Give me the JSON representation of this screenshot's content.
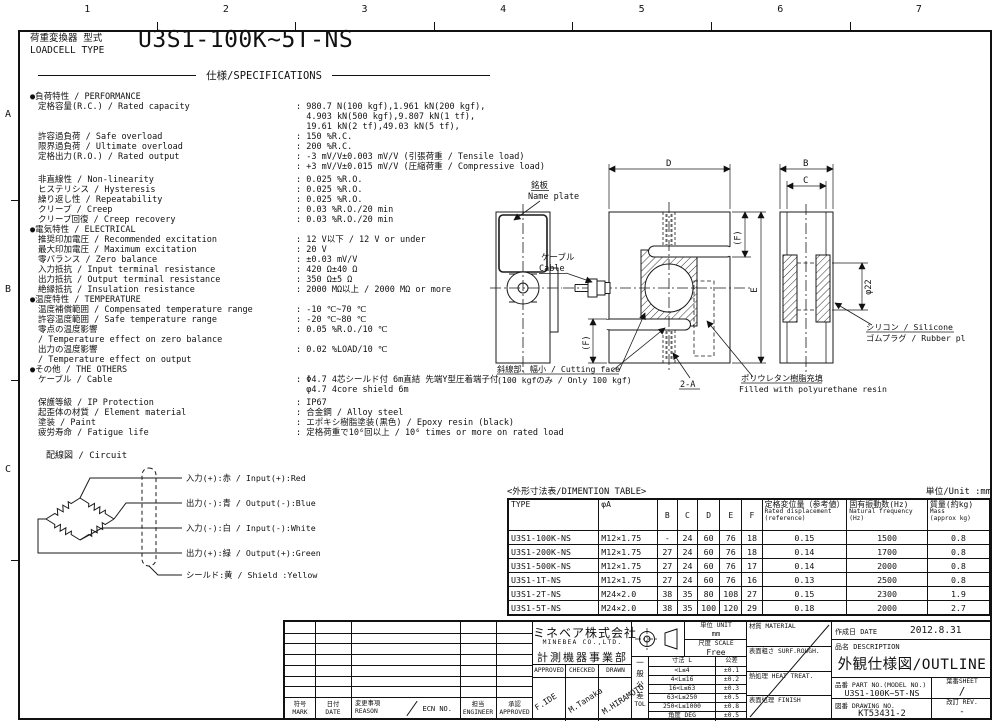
{
  "frame": {
    "top_numbers": [
      "1",
      "2",
      "3",
      "4",
      "5",
      "6",
      "7"
    ],
    "side_letters": [
      "A",
      "B",
      "C"
    ]
  },
  "header": {
    "type_label_jp": "荷重変換器 型式",
    "type_label_en": "LOADCELL TYPE",
    "model": "U3S1-100K~5T-NS",
    "spec_title": "仕様/SPECIFICATIONS"
  },
  "specs": [
    {
      "k": "s",
      "t": "●負荷特性 / PERFORMANCE"
    },
    {
      "k": "r",
      "l": "定格容量(R.C.) / Rated capacity",
      "v": ": 980.7 N(100 kgf),1.961 kN(200 kgf),"
    },
    {
      "k": "v",
      "v": "  4.903 kN(500 kgf),9.807 kN(1 tf),"
    },
    {
      "k": "v",
      "v": "  19.61 kN(2 tf),49.03 kN(5 tf),"
    },
    {
      "k": "r",
      "l": "許容過負荷 / Safe overload",
      "v": ": 150 %R.C."
    },
    {
      "k": "r",
      "l": "限界過負荷 / Ultimate overload",
      "v": ": 200 %R.C."
    },
    {
      "k": "r",
      "l": "定格出力(R.O.) / Rated output",
      "v": ": -3 mV/V±0.003 mV/V (引張荷重 / Tensile load)"
    },
    {
      "k": "v",
      "v": ": +3 mV/V±0.015 mV/V (圧縮荷重 / Compressive load)"
    },
    {
      "k": "g"
    },
    {
      "k": "r",
      "l": "非直線性 / Non-linearity",
      "v": ": 0.025 %R.O."
    },
    {
      "k": "r",
      "l": "ヒステリシス / Hysteresis",
      "v": ": 0.025 %R.O."
    },
    {
      "k": "r",
      "l": "繰り返し性 / Repeatability",
      "v": ": 0.025 %R.O."
    },
    {
      "k": "r",
      "l": "クリープ / Creep",
      "v": ": 0.03 %R.O./20 min"
    },
    {
      "k": "r",
      "l": "クリープ回復 / Creep recovery",
      "v": ": 0.03 %R.O./20 min"
    },
    {
      "k": "s",
      "t": "●電気特性 / ELECTRICAL"
    },
    {
      "k": "r",
      "l": "推奨印加電圧 / Recommended excitation",
      "v": ": 12 V以下 / 12 V or under"
    },
    {
      "k": "r",
      "l": "最大印加電圧 / Maximum excitation",
      "v": ": 20 V"
    },
    {
      "k": "r",
      "l": "零バランス / Zero balance",
      "v": ": ±0.03 mV/V"
    },
    {
      "k": "r",
      "l": "入力抵抗 / Input terminal resistance",
      "v": ": 420 Ω±40 Ω"
    },
    {
      "k": "r",
      "l": "出力抵抗 / Output terminal resistance",
      "v": ": 350 Ω±5 Ω"
    },
    {
      "k": "r",
      "l": "絶縁抵抗 / Insulation resistance",
      "v": ": 2000 MΩ以上 / 2000 MΩ or more"
    },
    {
      "k": "s",
      "t": "●温度特性 / TEMPERATURE"
    },
    {
      "k": "r",
      "l": "温度補償範囲 / Compensated temperature range",
      "v": ": -10 ℃~70 ℃"
    },
    {
      "k": "r",
      "l": "許容温度範囲 / Safe temperature range",
      "v": ": -20 ℃~80 ℃"
    },
    {
      "k": "r",
      "l": "零点の温度影響",
      "v": ": 0.05 %R.O./10 ℃"
    },
    {
      "k": "l",
      "l": "/ Temperature effect on zero balance"
    },
    {
      "k": "r",
      "l": "出力の温度影響",
      "v": ": 0.02 %LOAD/10 ℃"
    },
    {
      "k": "l",
      "l": "/ Temperature effect on output"
    },
    {
      "k": "s",
      "t": "●その他 / THE OTHERS"
    },
    {
      "k": "r",
      "l": "ケーブル / Cable",
      "v": ": Φ4.7 4芯シールド付 6m直結 先端Y型圧着端子付"
    },
    {
      "k": "v",
      "v": "  φ4.7 4core shield 6m"
    },
    {
      "k": "g"
    },
    {
      "k": "r",
      "l": "保護等級 / IP Protection",
      "v": ": IP67"
    },
    {
      "k": "r",
      "l": "起歪体の材質 / Element material",
      "v": ": 合金鋼 / Alloy steel"
    },
    {
      "k": "r",
      "l": "塗装 / Paint",
      "v": ": エポキシ樹脂塗装(黒色) / Epoxy resin (black)"
    },
    {
      "k": "r",
      "l": "疲労寿命 / Fatigue life",
      "v": ": 定格荷重で10⁶回以上 / 10⁶ times or more on rated load"
    }
  ],
  "circuit": {
    "title": "配線図 / Circuit",
    "wires": [
      "入力(+):赤 / Input(+):Red",
      "出力(-):青 / Output(-):Blue",
      "入力(-):白 / Input(-):White",
      "出力(+):緑 / Output(+):Green",
      "シールド:黄 / Shield :Yellow"
    ]
  },
  "drawing": {
    "dims": {
      "d": "D",
      "b": "B",
      "c": "C",
      "e": "E",
      "f": "(F)",
      "dia": "φ22"
    },
    "nameplate_jp": "銘板",
    "nameplate_en": "Name plate",
    "cable_jp": "ケーブル",
    "cable_en": "Cable",
    "cutting_jp": "斜線部、幅小 / Cutting face",
    "cutting_en": "(100 kgfのみ / Only 100 kgf)",
    "thread": "2-A",
    "resin_jp": "ポリウレタン樹脂充填",
    "resin_en": "Filled with polyurethane resin",
    "silicone_jp": "シリコン / Silicone",
    "silicone_en": "ゴムプラグ / Rubber plug"
  },
  "dim_table": {
    "title": "<外形寸法表/DIMENTION TABLE>",
    "unit": "単位/Unit :mm",
    "headers": [
      {
        "m": "TYPE"
      },
      {
        "m": "φA"
      },
      {
        "m": "B"
      },
      {
        "m": "C"
      },
      {
        "m": "D"
      },
      {
        "m": "E"
      },
      {
        "m": "F"
      },
      {
        "m": "定格変位量（参考値）",
        "s": [
          "Rated displacement",
          "(reference)"
        ]
      },
      {
        "m": "固有振動数(Hz)",
        "s": [
          "Natural frequency",
          "(Hz)"
        ]
      },
      {
        "m": "質量(約kg)",
        "s": [
          "Mass",
          "(approx kg)"
        ]
      }
    ],
    "rows": [
      [
        "U3S1-100K-NS",
        "M12×1.75",
        "-",
        "24",
        "60",
        "76",
        "18",
        "0.15",
        "1500",
        "0.8"
      ],
      [
        "U3S1-200K-NS",
        "M12×1.75",
        "27",
        "24",
        "60",
        "76",
        "18",
        "0.14",
        "1700",
        "0.8"
      ],
      [
        "U3S1-500K-NS",
        "M12×1.75",
        "27",
        "24",
        "60",
        "76",
        "17",
        "0.14",
        "2000",
        "0.8"
      ],
      [
        "U3S1-1T-NS",
        "M12×1.75",
        "27",
        "24",
        "60",
        "76",
        "16",
        "0.13",
        "2500",
        "0.8"
      ],
      [
        "U3S1-2T-NS",
        "M24×2.0",
        "38",
        "35",
        "80",
        "108",
        "27",
        "0.15",
        "2300",
        "1.9"
      ],
      [
        "U3S1-5T-NS",
        "M24×2.0",
        "38",
        "35",
        "100",
        "120",
        "29",
        "0.18",
        "2000",
        "2.7"
      ]
    ]
  },
  "title_block": {
    "revision": {
      "headers": [
        [
          "符号",
          "MARK"
        ],
        [
          "日付",
          "DATE"
        ],
        [
          "変更事項",
          "REASON"
        ],
        [
          "担当",
          "ENGINEER"
        ],
        [
          "承認",
          "APPROVED"
        ]
      ],
      "ecn": "ECN NO.",
      "empty_rows": 7
    },
    "company": {
      "jp": "ミネベア株式会社",
      "en": "MINEBEA CO.,LTD.",
      "division": "計測機器事業部"
    },
    "signatures": {
      "headers": [
        "APPROVED",
        "CHECKED",
        "DRAWN"
      ],
      "names": [
        "F.IDE",
        "M.Tanaka",
        "M.HIRAMOTO"
      ]
    },
    "unit": {
      "label": "単位 UNIT",
      "value": "mm"
    },
    "scale": {
      "label": "尺度 SCALE",
      "value": "Free"
    },
    "tolerance": {
      "side_jp": "一般公差",
      "side_en": "TOL",
      "col1": "寸法 L",
      "col2": "公差",
      "rows": [
        [
          "<L≤4",
          "±0.1"
        ],
        [
          "4<L≤16",
          "±0.2"
        ],
        [
          "16<L≤63",
          "±0.3"
        ],
        [
          "63<L≤250",
          "±0.5"
        ],
        [
          "250<L≤1000",
          "±0.8"
        ],
        [
          "角度 DEG",
          "±0.5"
        ]
      ]
    },
    "material_cells": [
      [
        "材質",
        "MATERIAL"
      ],
      [
        "表面粗さ",
        "SURF.ROUGH."
      ],
      [
        "熱処理",
        "HEAT TREAT."
      ],
      [
        "表面処理",
        "FINISH"
      ]
    ],
    "info": {
      "date_label": "作成日 DATE",
      "date": "2012.8.31",
      "desc_label": "品名 DESCRIPTION",
      "desc": "外観仕様図/OUTLINE",
      "part_label": "品番 PART NO.(MODEL NO.)",
      "part": "U3S1-100K~5T-NS",
      "sheet_label": "葉番SHEET",
      "sheet": "/",
      "dwg_label": "図番 DRAWING NO.",
      "dwg": "KT53431-2",
      "rev_label": "改訂 REV.",
      "rev": "-"
    }
  },
  "colors": {
    "ink": "#111111",
    "paper": "#ffffff"
  }
}
